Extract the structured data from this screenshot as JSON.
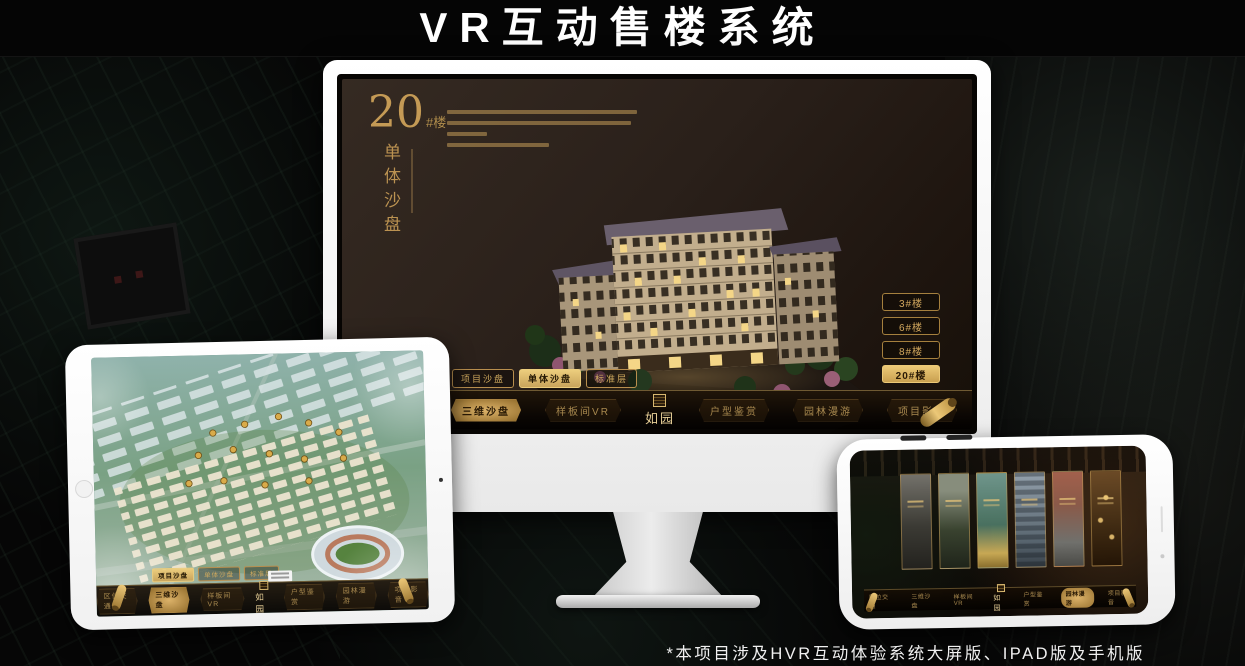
{
  "title": "VR互动售楼系统",
  "footnote": "*本项目涉及HVR互动体验系统大屏版、IPAD版及手机版",
  "colors": {
    "accent_gold": "#c9a45c",
    "active_gold": "#ecc977",
    "screen_bg": "#2a201a",
    "frame_white": "#ffffff"
  },
  "monitor": {
    "building_no": "20",
    "building_suffix": "#楼",
    "section_title": "单体沙盘",
    "floor_buttons": [
      {
        "label": "3#楼",
        "active": false
      },
      {
        "label": "6#楼",
        "active": false
      },
      {
        "label": "8#楼",
        "active": false
      },
      {
        "label": "20#楼",
        "active": true
      }
    ],
    "mode_tabs": [
      {
        "label": "项目沙盘",
        "active": false
      },
      {
        "label": "单体沙盘",
        "active": true
      },
      {
        "label": "标准层",
        "active": false
      }
    ],
    "nav": {
      "items": [
        "区位交通",
        "三维沙盘",
        "样板间VR",
        "户型鉴赏",
        "园林漫游",
        "项目影音"
      ],
      "active": "三维沙盘",
      "logo": "如园"
    }
  },
  "tablet": {
    "mode_tabs": [
      {
        "label": "项目沙盘",
        "active": true
      },
      {
        "label": "单体沙盘",
        "active": false
      },
      {
        "label": "标准层",
        "active": false
      }
    ],
    "nav": {
      "items": [
        "区位交通",
        "三维沙盘",
        "样板间VR",
        "户型鉴赏",
        "园林漫游",
        "项目影音"
      ],
      "active": "三维沙盘",
      "logo": "如园"
    }
  },
  "phone": {
    "nav": {
      "items": [
        "区位交通",
        "三维沙盘",
        "样板间VR",
        "户型鉴赏",
        "园林漫游",
        "项目影音"
      ],
      "active": "园林漫游",
      "logo": "如园"
    }
  }
}
